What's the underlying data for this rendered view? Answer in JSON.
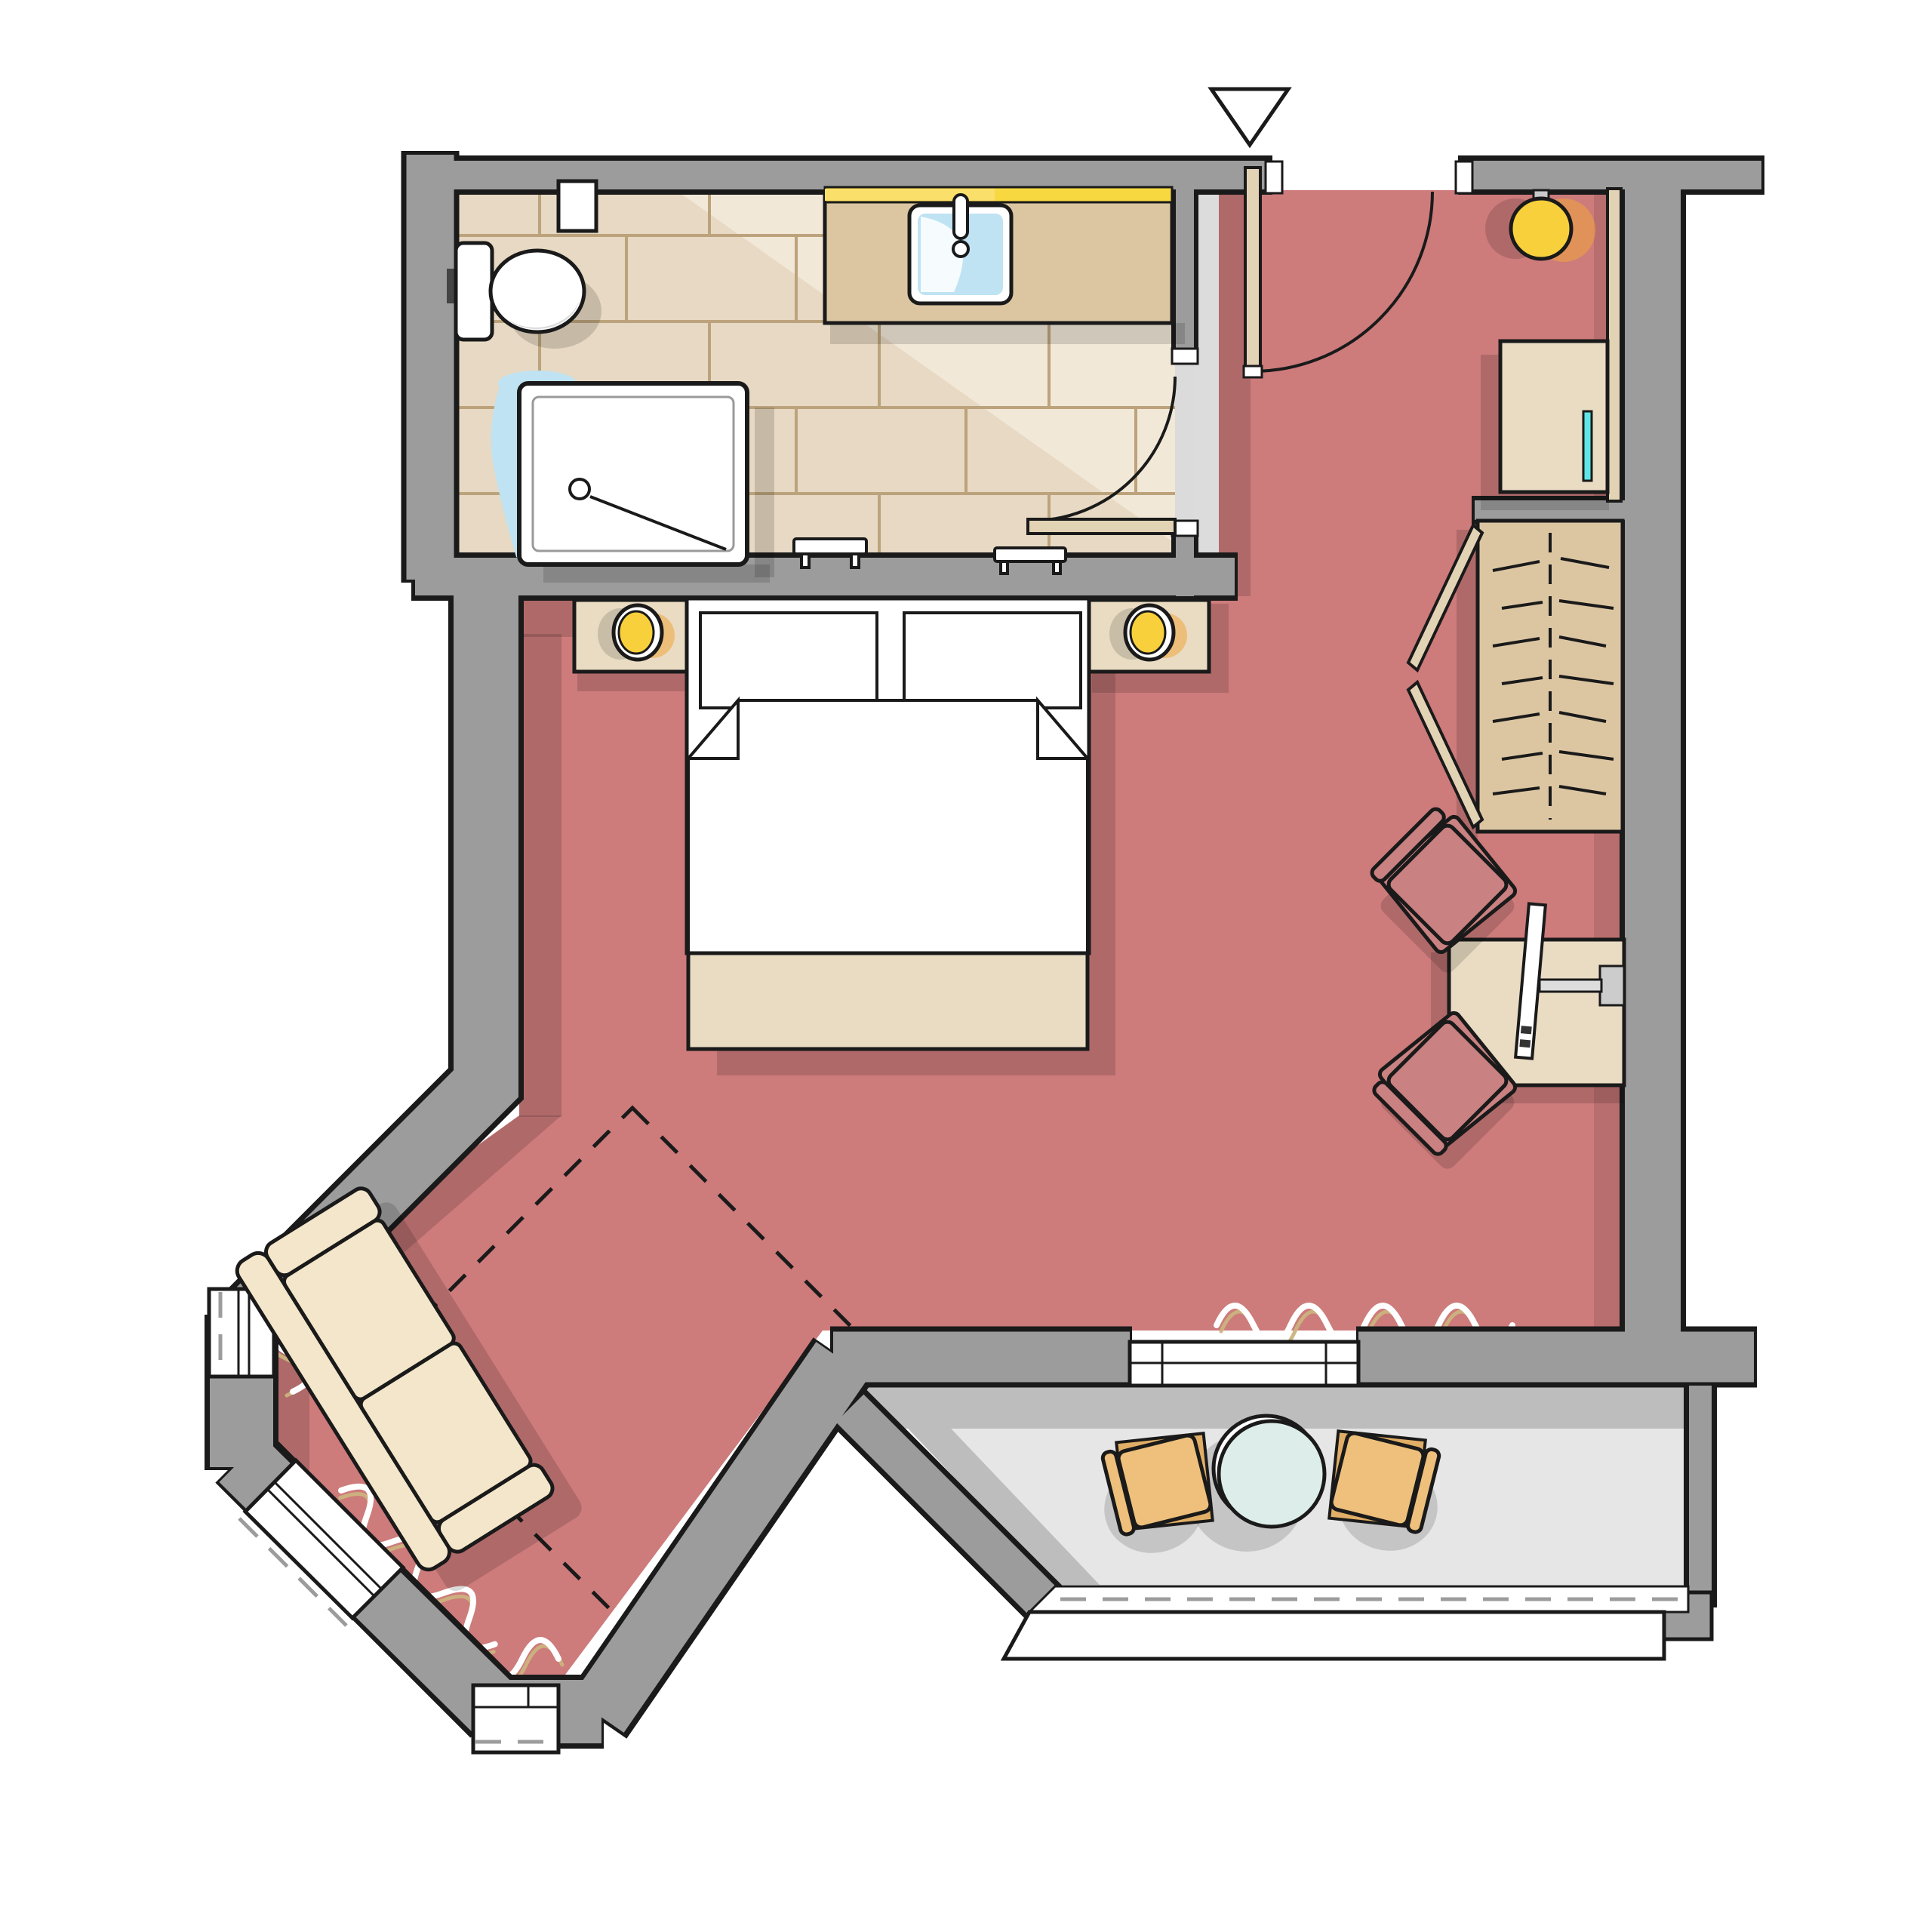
{
  "title": "Hotel guest room floor plan (top view)",
  "colors": {
    "outline": "#1a1a1a",
    "wall": "#9c9c9c",
    "floor_room": "#cd7b7b",
    "floor_bath": "#e7d9c3",
    "floor_bath_highlight": "#f2e8d8",
    "tile_line": "#bca37c",
    "floor_balcony": "#e6e6e6",
    "balcony_shadow": "#bdbdbd",
    "furniture_beige": "#e9dcc3",
    "furniture_tan": "#dcc6a2",
    "sofa_cream": "#f3e6ca",
    "chair_rose": "#ca8181",
    "chair_tan": "#eec07c",
    "door_leaf": "#e3d3b5",
    "lamp_yellow": "#f8d03c",
    "lamp_glow": "#f0a63c",
    "strip_yellow": "#f8d840",
    "accent_cyan": "#5fe6e6",
    "glass_blue": "#bfe3f2",
    "radiator_tan": "#cbb37e",
    "white": "#ffffff",
    "threshold_grey": "#dcdcdc",
    "shadow": "rgba(0,0,0,0.14)"
  },
  "rooms": [
    {
      "id": "bathroom",
      "label": "bathroom with tiled floor"
    },
    {
      "id": "entry",
      "label": "entry hall"
    },
    {
      "id": "bedroom",
      "label": "bedroom / living area"
    },
    {
      "id": "bay",
      "label": "bay window sitting corner"
    },
    {
      "id": "balcony",
      "label": "balcony"
    }
  ],
  "furniture": {
    "bathroom": [
      "toilet",
      "shower",
      "vanity with sink",
      "mirror light strip",
      "towel rail",
      "wall niche"
    ],
    "entry": [
      "entrance door",
      "pendant lamp",
      "console table",
      "wardrobe with open doors"
    ],
    "bedroom": [
      "double bed with two pillows",
      "nightstand with lamp (left)",
      "nightstand with lamp (right)",
      "foot bench",
      "dashed rug outline",
      "two-seat sofa"
    ],
    "work_corner": [
      "desk",
      "armchair upper",
      "armchair lower",
      "wall mounted tv"
    ],
    "balcony": [
      "round table",
      "armchair left",
      "armchair right",
      "railing",
      "sliding glass door"
    ]
  },
  "symbols": {
    "entrance_marker": "white triangle pointing down above entrance",
    "door_swings": 2,
    "bay_windows": 3,
    "radiators": "wavy line pairs along windows"
  }
}
